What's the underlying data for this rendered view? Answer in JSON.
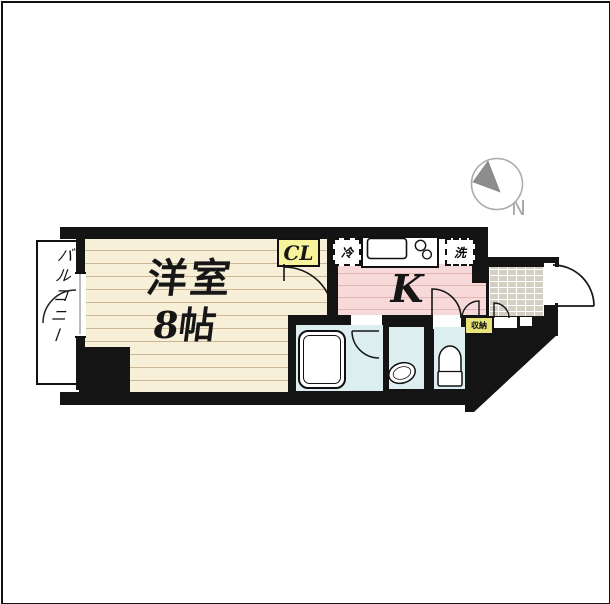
{
  "floorplan": {
    "title": "1K apartment floor plan",
    "compass": {
      "label": "N"
    },
    "rooms": {
      "balcony": {
        "label": "バルコニー"
      },
      "western_room": {
        "label": "洋室",
        "size": "8帖"
      },
      "kitchen": {
        "label": "K"
      },
      "closet": {
        "label": "CL"
      },
      "storage": {
        "label": "収納"
      },
      "refrigerator": {
        "label": "冷"
      },
      "washing_machine": {
        "label": "洗"
      }
    },
    "colors": {
      "wall": "#141414",
      "room_floor": "#f8efd8",
      "room_floor_line": "#cbb795",
      "kitchen_floor": "#f6d9d8",
      "kitchen_floor_line": "#e3b6b6",
      "wet_area": "#ddeef1",
      "closet_yellow": "#f7f49b",
      "storage_yellow": "#e8e37a",
      "entrance_tile": "#d4cfc3",
      "compass_gray": "#8d8d8d"
    }
  }
}
